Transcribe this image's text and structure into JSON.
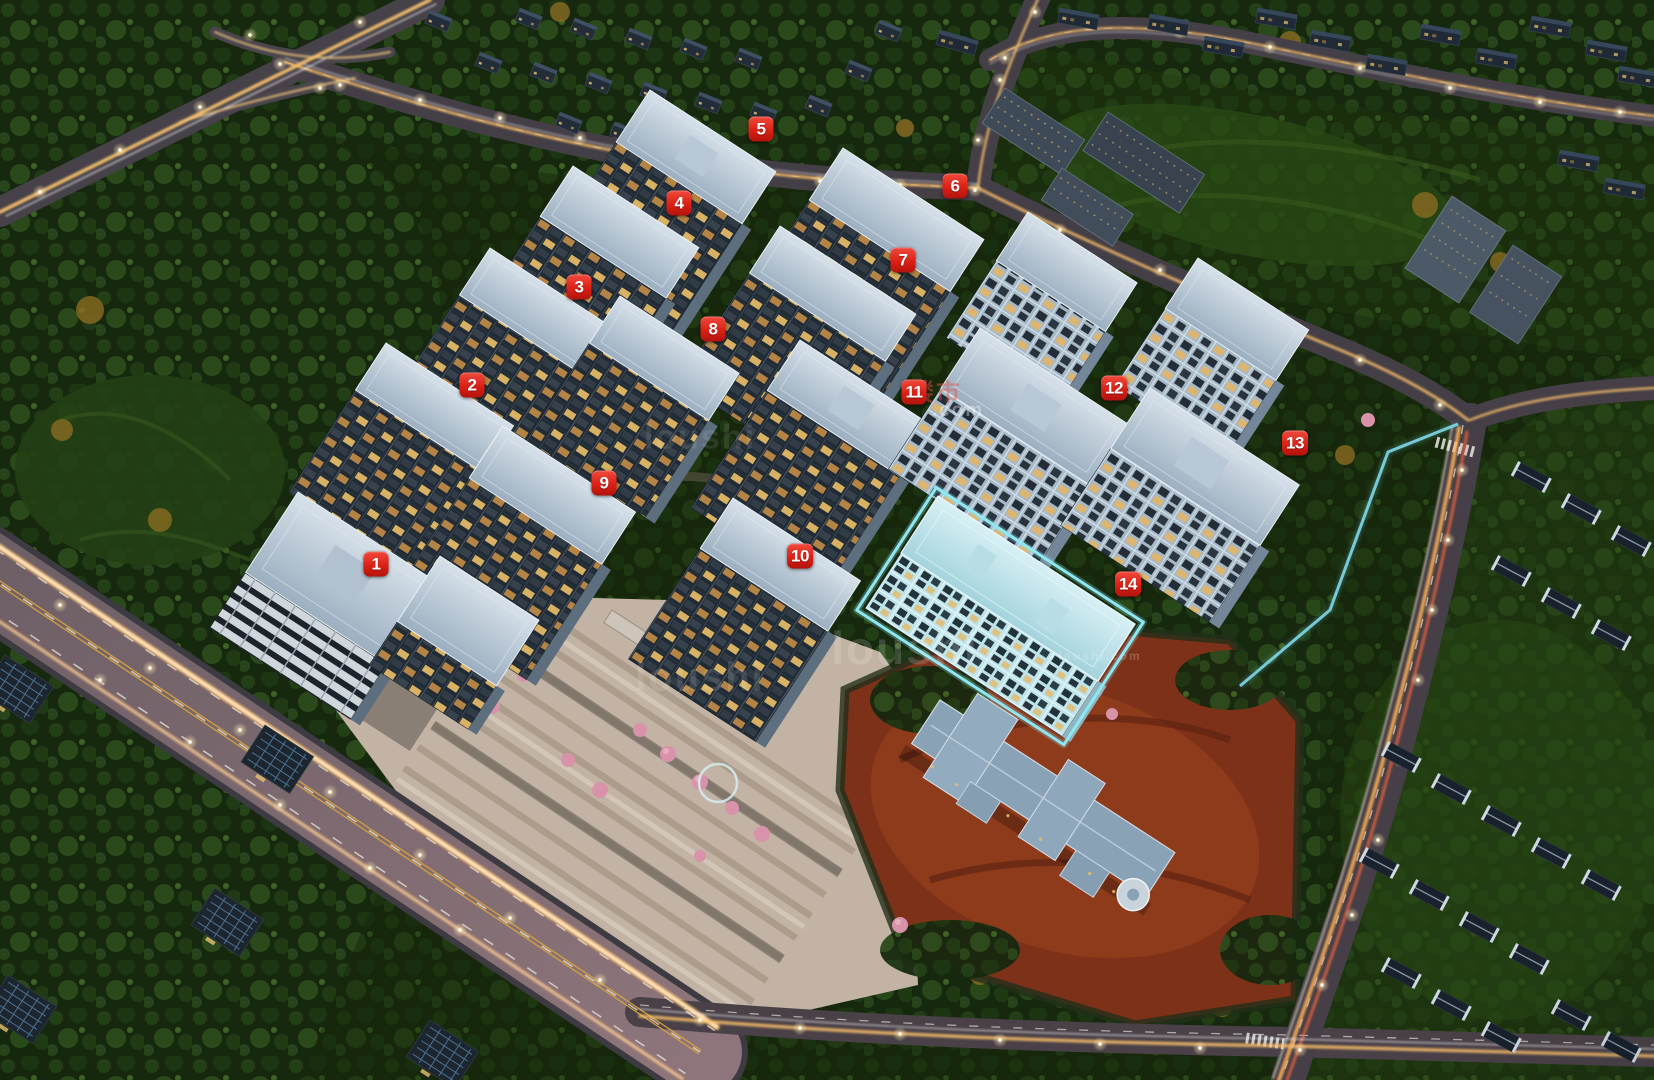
{
  "scene": {
    "width": 1654,
    "height": 1080,
    "colors": {
      "marker_red": "#dc2015",
      "marker_text": "#ffffff",
      "highlight_cyan": "#8fe7f2",
      "trail_gold": "#ffc56a",
      "forest_green": "#1b2f10",
      "plaza_tan": "#c3b3a4",
      "clay_red": "#7c3118",
      "roof_gray": "#b9c8d6"
    }
  },
  "markers": [
    {
      "number": "1",
      "x": 376,
      "y": 564
    },
    {
      "number": "2",
      "x": 472,
      "y": 385
    },
    {
      "number": "3",
      "x": 579,
      "y": 287
    },
    {
      "number": "4",
      "x": 679,
      "y": 203
    },
    {
      "number": "5",
      "x": 761,
      "y": 129
    },
    {
      "number": "6",
      "x": 955,
      "y": 186
    },
    {
      "number": "7",
      "x": 903,
      "y": 260
    },
    {
      "number": "8",
      "x": 713,
      "y": 329
    },
    {
      "number": "9",
      "x": 604,
      "y": 483
    },
    {
      "number": "10",
      "x": 800,
      "y": 556
    },
    {
      "number": "11",
      "x": 914,
      "y": 392
    },
    {
      "number": "12",
      "x": 1114,
      "y": 388
    },
    {
      "number": "13",
      "x": 1295,
      "y": 443
    },
    {
      "number": "14",
      "x": 1128,
      "y": 584,
      "highlighted": true
    }
  ],
  "highlight": {
    "building_number": "14",
    "outline_color": "#8fe7f2"
  },
  "watermarks": [
    {
      "text": "loushi",
      "x": 905,
      "y": 648,
      "size": 46,
      "opacity": 0.16,
      "color": "#ffffff"
    },
    {
      "text": "loushi",
      "x": 700,
      "y": 678,
      "size": 40,
      "opacity": 0.12,
      "color": "#ffffff"
    },
    {
      "text": "loushi",
      "x": 700,
      "y": 438,
      "size": 34,
      "opacity": 0.1,
      "color": "#ffffff"
    },
    {
      "text": "楼市",
      "x": 936,
      "y": 390,
      "size": 24,
      "opacity": 0.45,
      "color": "#e2574a"
    },
    {
      "text": ".com",
      "x": 958,
      "y": 411,
      "size": 19,
      "opacity": 0.35,
      "color": "#ffffff"
    },
    {
      "text": "loushi.com",
      "x": 1100,
      "y": 656,
      "size": 12,
      "opacity": 0.22,
      "color": "#ffffff"
    }
  ]
}
